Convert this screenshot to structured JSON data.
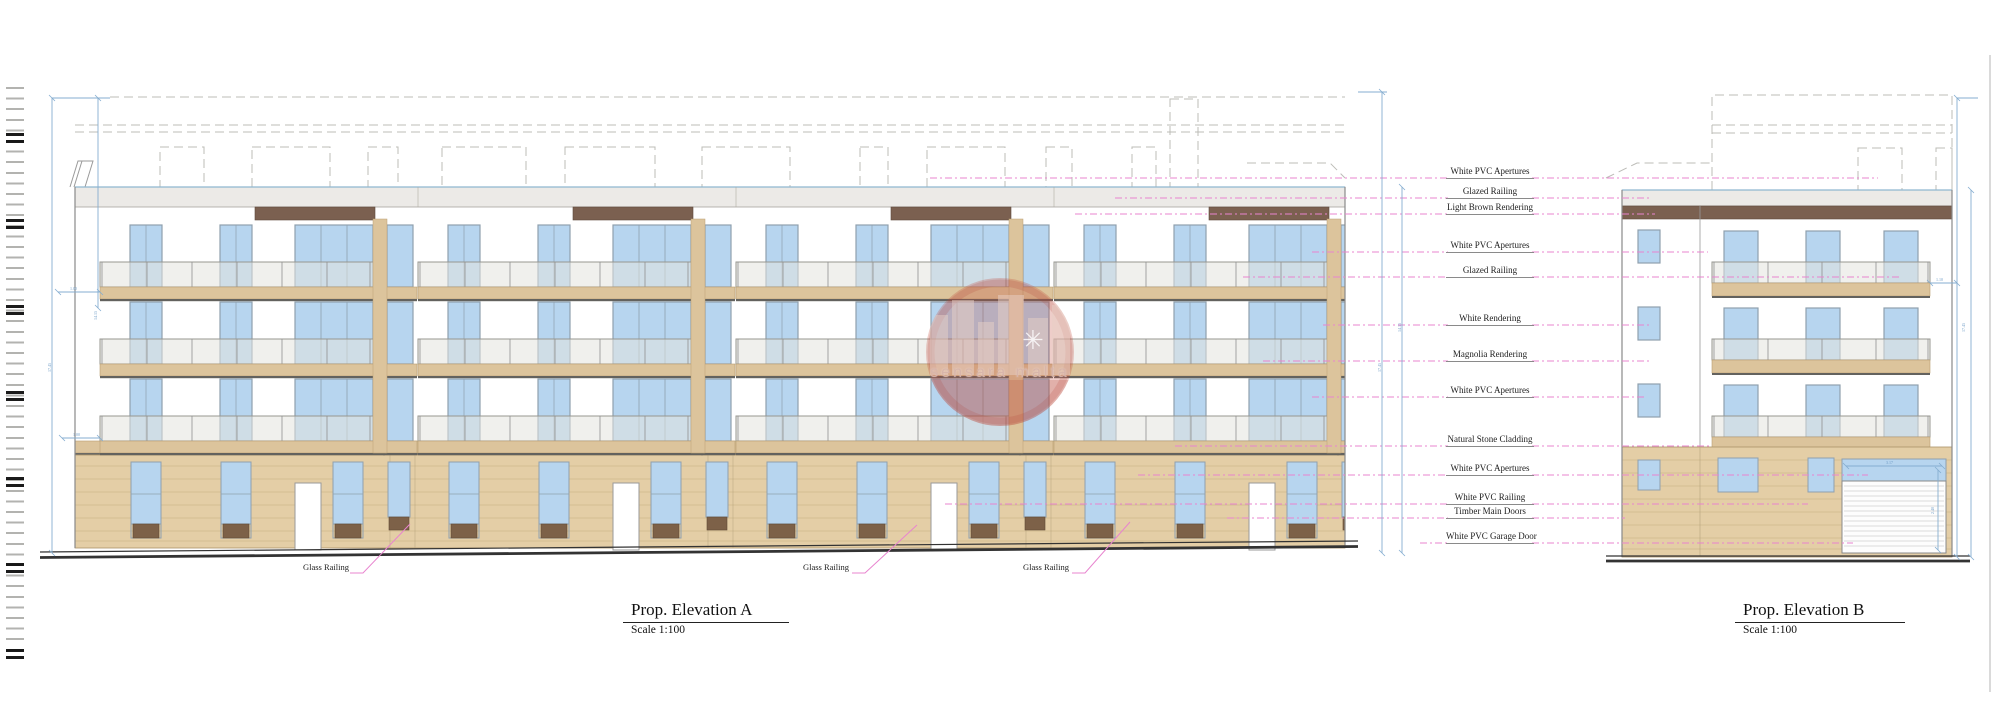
{
  "drawing": {
    "elevation_a": {
      "title": "Prop. Elevation A",
      "scale": "Scale 1:100"
    },
    "elevation_b": {
      "title": "Prop. Elevation B",
      "scale": "Scale 1:100"
    }
  },
  "annotations": [
    "White PVC Apertures",
    "Glazed Railing",
    "Light Brown Rendering",
    "White PVC Apertures",
    "Glazed Railing",
    "White Rendering",
    "Magnolia Rendering",
    "White PVC Apertures",
    "Natural Stone Cladding",
    "White PVC Apertures",
    "White PVC Railing",
    "Timber Main Doors",
    "White PVC Garage Door"
  ],
  "callouts": {
    "glass_railing_1": "Glass Railing",
    "glass_railing_2": "Glass Railing",
    "glass_railing_3": "Glass Railing"
  },
  "watermark": {
    "text": "sensara malta",
    "star_glyph": "✳"
  },
  "dimensions": {
    "balcony_depth_upper": "1.00",
    "balcony_depth_lower": "1.00",
    "height_left_outer": "17.45",
    "height_left_inner": "14.15",
    "height_right_outer": "17.45",
    "height_right_inner": "14.15",
    "balcony_depth_b": "1.10",
    "height_b_right": "17.45",
    "garage_width": "3.17",
    "garage_height": "2.40"
  },
  "colors": {
    "leader_pink": "#e884cf",
    "window_blue": "#b7d5ef",
    "stone_tan": "#e4cea6",
    "slab_tan": "#dcc49c",
    "band_brown": "#7b6050",
    "parapet_grey": "#eceae7",
    "dim_blue": "#85add0"
  }
}
